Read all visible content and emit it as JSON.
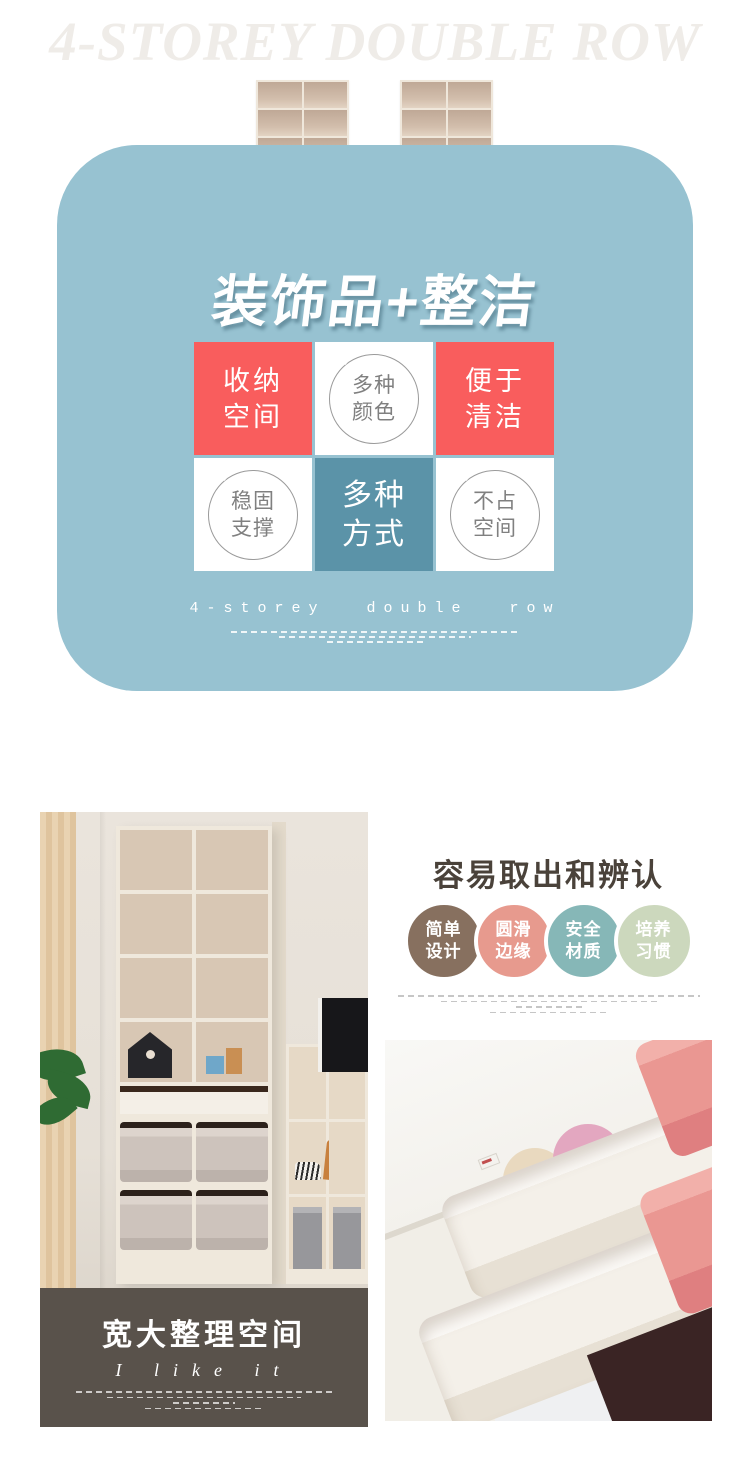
{
  "header": {
    "title": "4-STOREY DOUBLE ROW"
  },
  "products": {
    "left_unit": "shelf with navy drawers",
    "right_unit": "shelf with pink drawers",
    "drawer_navy": "#2f4f7c",
    "drawer_pink": "#cf6f64"
  },
  "feature_card": {
    "bg": "#97c2d1",
    "tile_red": "#f95d5d",
    "tile_teal": "#5b93a8",
    "title": "装饰品+整洁",
    "tiles": [
      {
        "style": "red",
        "line1": "收纳",
        "line2": "空间"
      },
      {
        "style": "circle",
        "line1": "多种",
        "line2": "颜色"
      },
      {
        "style": "red",
        "line1": "便于",
        "line2": "清洁"
      },
      {
        "style": "circle",
        "line1": "稳固",
        "line2": "支撑"
      },
      {
        "style": "teal",
        "line1": "多种",
        "line2": "方式"
      },
      {
        "style": "circle",
        "line1": "不占",
        "line2": "空间"
      }
    ],
    "footer_text": "4-storey double row"
  },
  "left_section": {
    "overlay_bg": "#59524b",
    "overlay_title": "宽大整理空间",
    "overlay_subtitle": "I like it"
  },
  "right_section": {
    "title": "容易取出和辨认",
    "badges": [
      {
        "line1": "简单",
        "line2": "设计",
        "color": "#87705f"
      },
      {
        "line1": "圆滑",
        "line2": "边缘",
        "color": "#e79a8e"
      },
      {
        "line1": "安全",
        "line2": "材质",
        "color": "#86b7b7"
      },
      {
        "line1": "培养",
        "line2": "习惯",
        "color": "#ccd8bd"
      }
    ]
  }
}
